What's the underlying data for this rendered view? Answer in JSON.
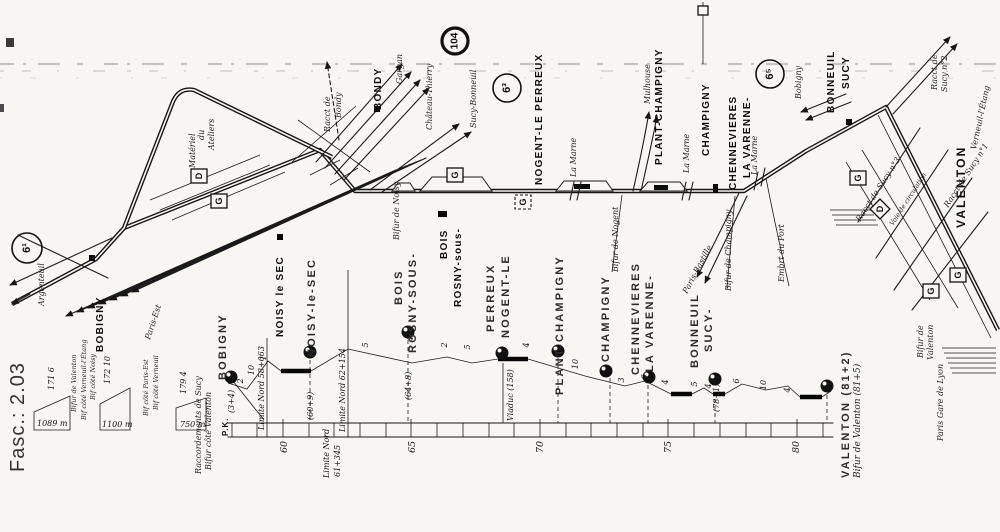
{
  "doc": {
    "fascicule": "Fasc.: 2.03"
  },
  "theme": {
    "paper": "#f7f6f2",
    "ink": "#1b1b1b"
  },
  "refs": {
    "plate_left": "6¹",
    "plate_mid": "6³",
    "plate_right": "6⁵",
    "line_number": "104"
  },
  "map": {
    "station": {
      "bobigny": "BOBIGNY",
      "bondy": "BONDY",
      "noisy": "NOISY le SEC",
      "rosny_a": "ROSNY-sous-",
      "rosny_b": "BOIS",
      "nogent": "NOGENT-LE PERREUX",
      "plant": "PLANT-CHAMPIGNY",
      "champigny": "CHAMPIGNY",
      "varenne_a": "LA VARENNE-",
      "varenne_b": "CHENNEVIERES",
      "sucy_a": "SUCY",
      "sucy_b": "BONNEUIL",
      "valenton": "VALENTON"
    },
    "dest": {
      "argenteuil": "Argenteuil",
      "paris_est": "Paris-Est",
      "gargan": "Gargan",
      "chateau_thierry": "Château-Thierry",
      "sucy_bonneuil": "Sucy-Bonneuil",
      "mulhouse": "Mulhouse",
      "paris_bastille": "Paris-Bastille",
      "bobigny": "Bobigny",
      "verneuil": "Verneuil-l'Étang"
    },
    "feature": {
      "ateliers_a": "Ateliers",
      "ateliers_b": "du",
      "ateliers_c": "Matériel",
      "racc_bondy_a": "Racct de",
      "racc_bondy_b": "Bondy",
      "bifur_noisy": "Bifur de Noisy",
      "la_marne": "La Marne",
      "bifur_nogent": "Bifur de Nogent",
      "bifur_champigny": "Bifur de Champigny",
      "embrt_port": "Embrt du Port",
      "racc_sucy2_a": "Racct de",
      "racc_sucy2_b": "Sucy n°2",
      "racc_sucy1": "Racct de Sucy n°1",
      "racc_sucy3": "Racct de Sucy n°3",
      "voie_circ": "Voie de circulation",
      "pgl_a": "Bifur de",
      "pgl_b": "Valenton",
      "pgl_c": "Paris Gare de Lyon"
    },
    "icon": {
      "g": "G",
      "d": "D"
    }
  },
  "profile": {
    "station": {
      "bobigny": "BOBIGNY",
      "noisy": "NOISY-le-SEC",
      "rosny_a": "ROSNY-SOUS-",
      "rosny_b": "BOIS",
      "nogent_a": "NOGENT-LE",
      "nogent_b": "PERREUX",
      "plant": "PLANT-CHAMPIGNY",
      "champigny": "CHAMPIGNY",
      "varenne_a": "LA VARENNE-",
      "varenne_b": "CHENNEVIERES",
      "sucy_a": "SUCY-",
      "sucy_b": "BONNEUIL",
      "valenton": "VALENTON (81+2)",
      "bifur_valenton": "Bifur de Valenton (81+5)"
    },
    "pk_label": "P.K.",
    "pk": [
      "60",
      "65",
      "70",
      "75",
      "80"
    ],
    "limit": {
      "a": "Limite Nord  58+063",
      "b": "Limite Nord  62+154",
      "c_a": "Limite Nord",
      "c_b": "61+345"
    },
    "mark": {
      "bobigny": "(3+4)",
      "noisy": "(60+9)",
      "rosny": "(64+8)",
      "nogent": "Viaduc (158)",
      "sucy": "(78+1)"
    },
    "grad": [
      "2",
      "10",
      "1",
      "5",
      "4",
      "2",
      "5",
      "4",
      "10",
      "3",
      "6",
      "4",
      "5",
      "4",
      "6",
      "10",
      "4"
    ],
    "racc": {
      "title_a": "Raccordements de Sucy",
      "title_b": "Bifur côté Valenton",
      "bar1_len": "1089 m",
      "bar2_len": "1100 m",
      "bar3_len": "750 m",
      "bar1_grad": "171 6",
      "bar2_grad": "172 10",
      "bar3_grad": "179 4",
      "lbl_valenton": "Bifur de Valenton",
      "lbl_noisy": "Bif côté Noisy",
      "lbl_verneuil_letang": "Bif côté Verneuil-l'Étang",
      "lbl_paris_est": "Bif côté Paris-Est",
      "lbl_verneuil": "Bif côté Verneuil"
    }
  }
}
